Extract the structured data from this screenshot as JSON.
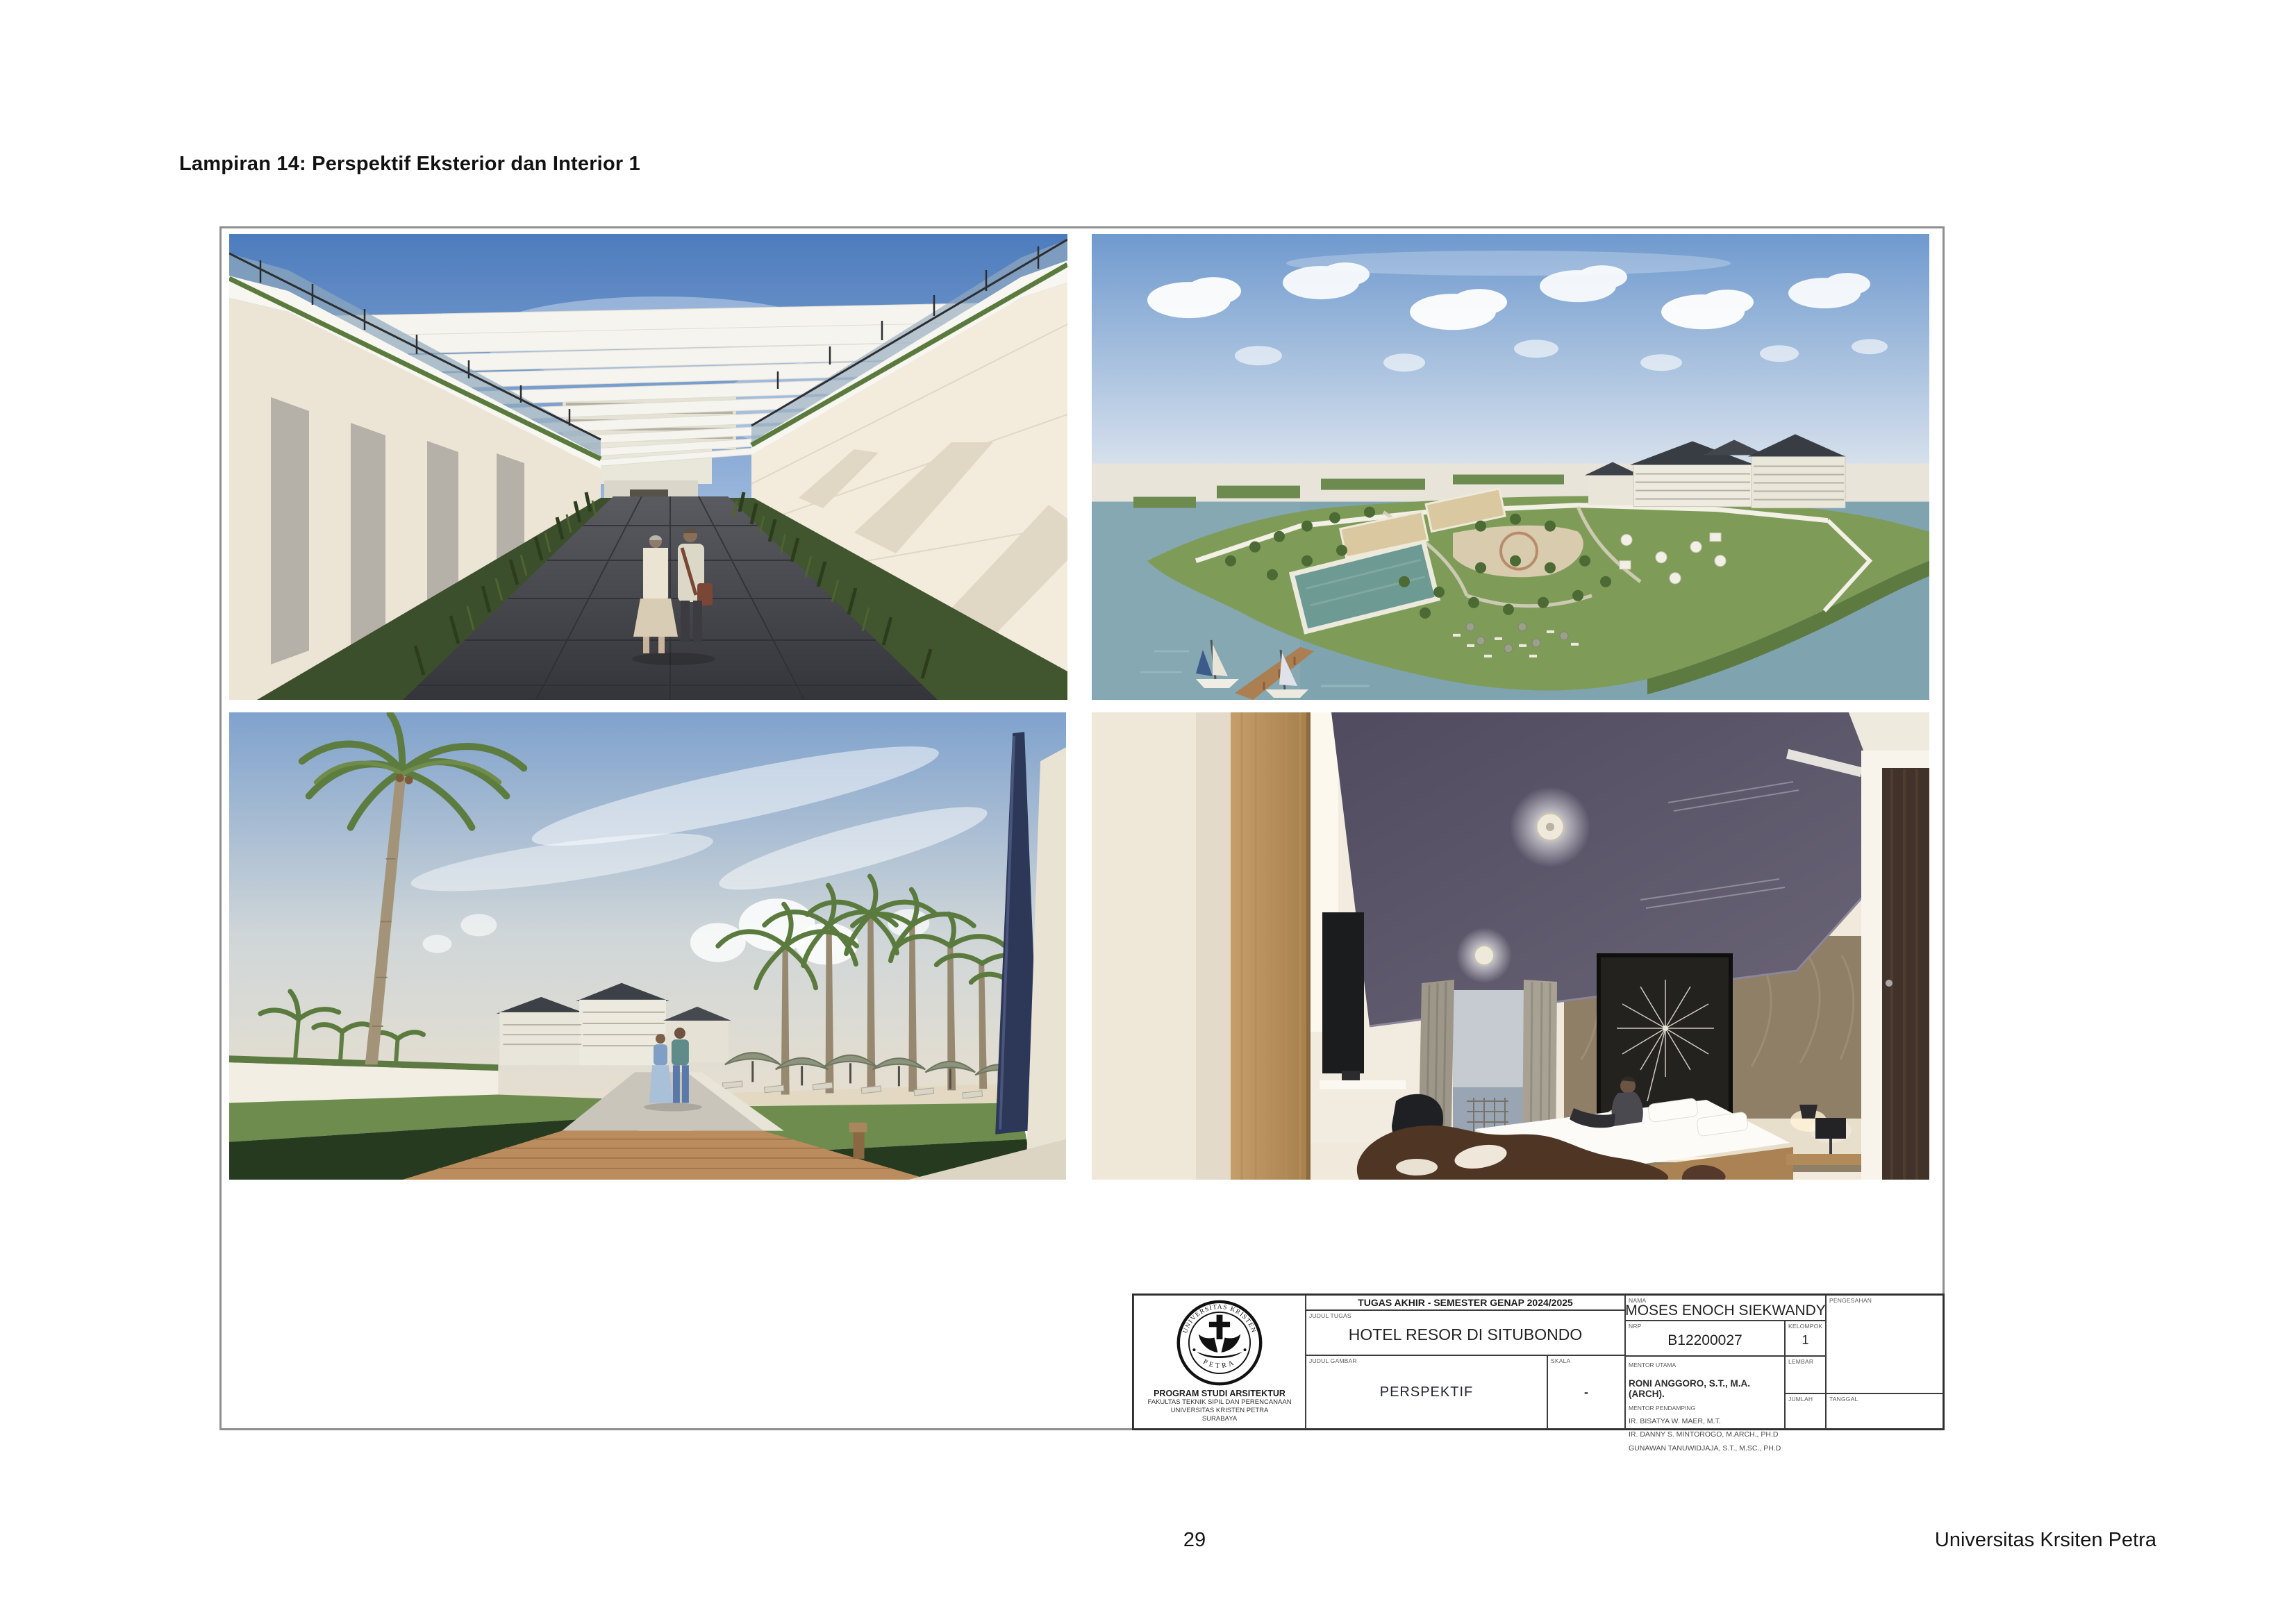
{
  "doc": {
    "heading": "Lampiran 14: Perspektif Eksterior dan Interior 1",
    "page_number": "29",
    "footer_right": "Universitas Krsiten Petra"
  },
  "figures": {
    "top_left": "exterior-corridor-perspective-render",
    "top_right": "aerial-resort-site-render",
    "bottom_left": "palm-walkway-perspective-render",
    "bottom_right": "hotel-room-interior-render"
  },
  "title_block": {
    "project_header": "TUGAS AKHIR - SEMESTER GENAP 2024/2025",
    "labels": {
      "judul_tugas": "JUDUL TUGAS",
      "judul_gambar": "JUDUL GAMBAR",
      "skala": "SKALA",
      "nama": "NAMA",
      "nrp": "NRP",
      "kelompok": "KELOMPOK",
      "mentor_utama": "MENTOR UTAMA",
      "mentor_pendamping": "MENTOR PENDAMPING",
      "lembar": "LEMBAR",
      "jumlah": "JUMLAH",
      "pengesahan": "PENGESAHAN",
      "tanggal": "TANGGAL"
    },
    "judul_tugas_value": "HOTEL RESOR DI SITUBONDO",
    "judul_gambar_value": "PERSPEKTIF",
    "skala_value": "-",
    "nama_value": "MOSES ENOCH SIEKWANDY",
    "nrp_value": "B12200027",
    "kelompok_value": "1",
    "mentor_utama_value": "RONI ANGGORO, S.T., M.A.(ARCH).",
    "mentor_pendamping_values": [
      "IR. BISATYA W. MAER, M.T.",
      "IR. DANNY S. MINTOROGO, M.ARCH., PH.D",
      "GUNAWAN TANUWIDJAJA, S.T., M.SC., PH.D"
    ],
    "institution": {
      "logo_top": "UNIVERSITAS KRISTEN",
      "logo_bottom": "PETRA",
      "program": "PROGRAM STUDI ARSITEKTUR",
      "faculty": "FAKULTAS TEKNIK SIPIL DAN PERENCANAAN",
      "university": "UNIVERSITAS KRISTEN PETRA",
      "city": "SURABAYA"
    }
  },
  "colors": {
    "frame_border": "#8f8f8f",
    "title_block_border": "#2e2e2e",
    "sky_blue": "#4d7cbd",
    "water": "#7fa4b0",
    "grass": "#6d8c4d",
    "dark_roof": "#383d44",
    "wood_deck": "#bb8c5e",
    "ceiling_panel": "#575165",
    "text": "#151515"
  }
}
